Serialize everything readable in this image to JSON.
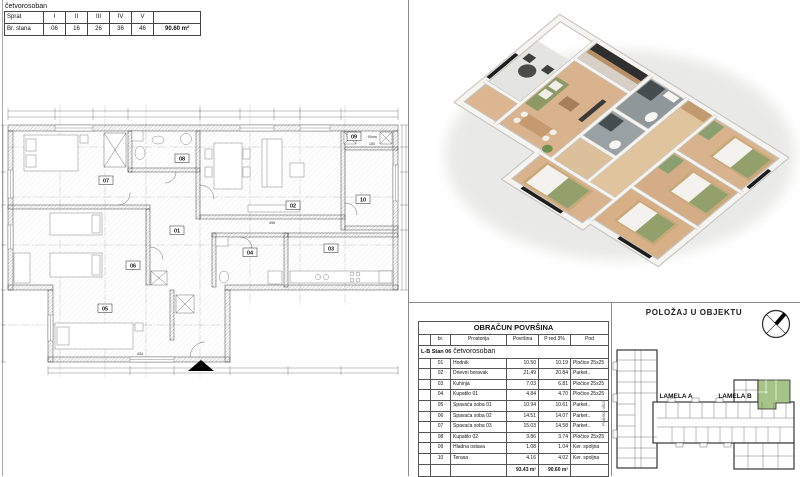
{
  "header_table": {
    "title": "četvorosoban",
    "rows": [
      {
        "label": "Sprat",
        "values": [
          "I",
          "II",
          "III",
          "IV",
          "V"
        ]
      },
      {
        "label": "Br. stana",
        "values": [
          "06",
          "16",
          "26",
          "36",
          "46"
        ]
      }
    ],
    "area_total": "90.60 m²"
  },
  "floor_plan": {
    "rooms": [
      "01",
      "02",
      "03",
      "04",
      "05",
      "06",
      "07",
      "08",
      "09",
      "10"
    ],
    "klima_label": "Klima",
    "dims": {
      "d1": "496",
      "d2": "434",
      "d3": "150"
    }
  },
  "area_table": {
    "title": "OBRAČUN POVRŠINA",
    "columns": [
      "br.",
      "Prostorija",
      "Površina",
      "P red 3%",
      "Pod"
    ],
    "group_label": "L-B Stan 06",
    "group_type": "četvorosoban",
    "rows": [
      [
        "01",
        "Hodnik",
        "10.50",
        "10.19",
        "Pločice 25x25"
      ],
      [
        "02",
        "Dnevni boravak",
        "21.49",
        "20.84",
        "Parket.."
      ],
      [
        "03",
        "Kuhinja",
        "7.03",
        "6.81",
        "Pločice 25x25"
      ],
      [
        "04",
        "Kupatilo 01",
        "4.84",
        "4.70",
        "Pločice 25x25"
      ],
      [
        "05",
        "Spavaća soba 01",
        "10.94",
        "10.61",
        "Parket.."
      ],
      [
        "06",
        "Spavaća soba 02",
        "14.51",
        "14.07",
        "Parket.."
      ],
      [
        "07",
        "Spavaća soba 03",
        "15.03",
        "14.58",
        "Parket.."
      ],
      [
        "08",
        "Kupatilo 02",
        "3.86",
        "3.74",
        "Pločice 25x25"
      ],
      [
        "09",
        "Hladna ostava",
        "1.08",
        "1.04",
        "Ker. spoljna"
      ],
      [
        "10",
        "Terasa",
        "4.16",
        "4.02",
        "Ker. spoljna"
      ]
    ],
    "total_povrsina": "93.43 m²",
    "total_reduced": "90.60 m²"
  },
  "position_panel": {
    "title": "POLOŽAJ U OBJEKTU",
    "lamela_a": "LAMELA A",
    "lamela_b": "LAMELA B",
    "street": "Pariska ulica",
    "highlight_color": "#a6c487"
  }
}
